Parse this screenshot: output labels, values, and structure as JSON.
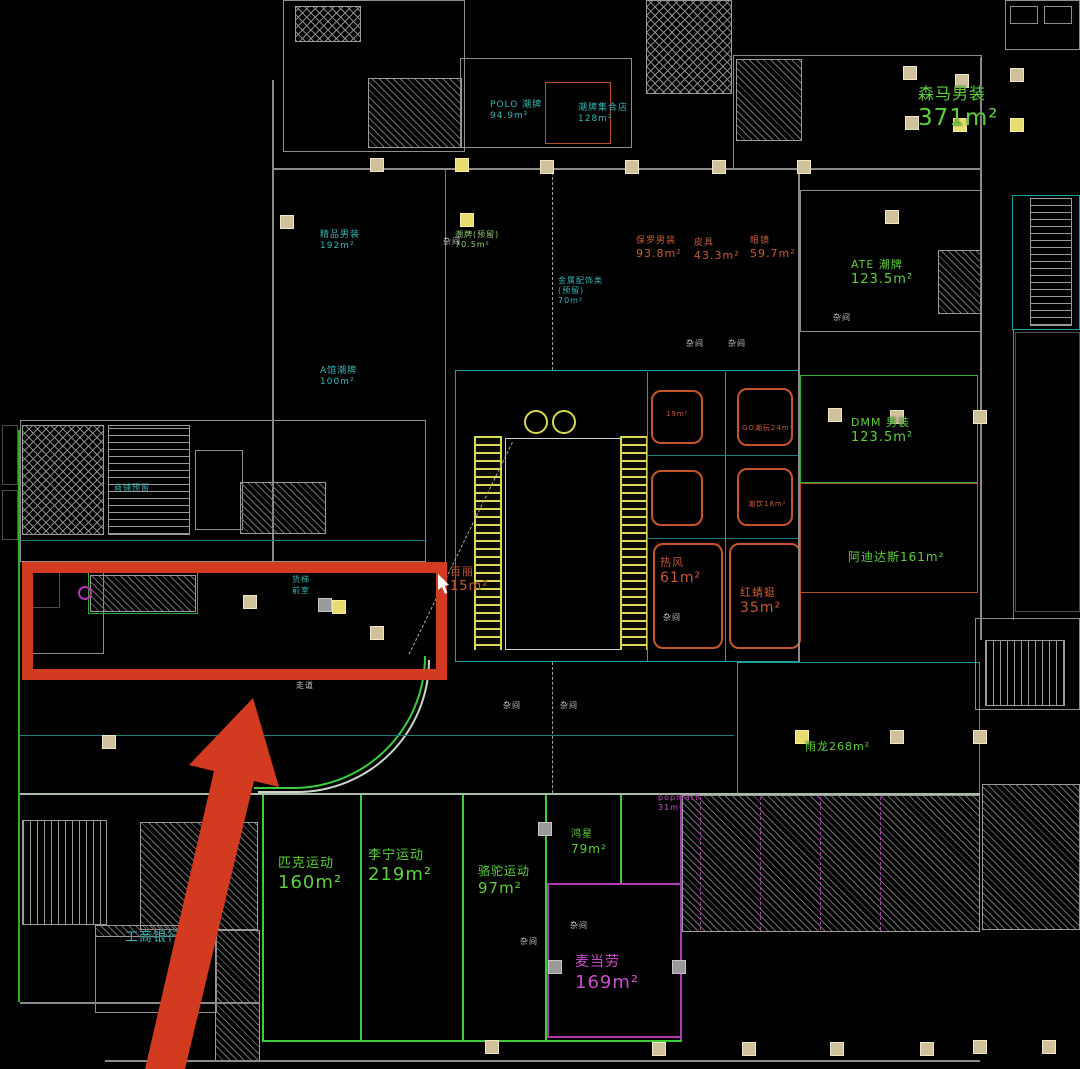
{
  "drawing": {
    "type": "cad-floor-plan",
    "background": "#000000",
    "accent_colors": {
      "highlight_red": "#d23b20",
      "tenant_green": "#5ecf3e",
      "tenant_cyan": "#36b6b6",
      "tenant_orange": "#c65a35",
      "tenant_magenta": "#c94fc9",
      "escalator_yellow": "#d8d855",
      "column_tan": "#cfc19c"
    },
    "annotations": {
      "highlight_rect": {
        "color": "#d23b20"
      },
      "arrow": {
        "color": "#d23b20"
      },
      "cursor": {
        "color": "#ffffff"
      }
    },
    "stores": [
      {
        "id": "senma",
        "color": "#5ecf3e",
        "x": 918,
        "y": 84,
        "lines": [
          {
            "t": "森马男装",
            "s": 16
          },
          {
            "t": "371m²",
            "s": 23
          }
        ]
      },
      {
        "id": "polo",
        "color": "#36b6b6",
        "x": 490,
        "y": 100,
        "lines": [
          {
            "t": "POLO 潮牌",
            "s": 9
          },
          {
            "t": "94.9m²",
            "s": 9
          }
        ]
      },
      {
        "id": "jihe",
        "color": "#36b6b6",
        "x": 578,
        "y": 103,
        "lines": [
          {
            "t": "潮牌集合店",
            "s": 9
          },
          {
            "t": "128m²",
            "s": 9
          }
        ]
      },
      {
        "id": "mens192",
        "color": "#36b6b6",
        "x": 320,
        "y": 230,
        "lines": [
          {
            "t": "精品男装",
            "s": 9
          },
          {
            "t": "192m²",
            "s": 9
          }
        ]
      },
      {
        "id": "chaopai705",
        "color": "#8fcf6f",
        "x": 455,
        "y": 230,
        "lines": [
          {
            "t": "潮牌(预留)",
            "s": 8
          },
          {
            "t": "70.5m²",
            "s": 8
          }
        ]
      },
      {
        "id": "jinshu",
        "color": "#36b6b6",
        "x": 558,
        "y": 276,
        "lines": [
          {
            "t": "金属配饰类",
            "s": 8
          },
          {
            "t": "(预留)",
            "s": 8
          },
          {
            "t": "70m²",
            "s": 8
          }
        ]
      },
      {
        "id": "baoluo",
        "color": "#c65a35",
        "x": 636,
        "y": 236,
        "lines": [
          {
            "t": "保罗男装",
            "s": 9
          },
          {
            "t": "93.8m²",
            "s": 11
          }
        ]
      },
      {
        "id": "piju",
        "color": "#c65a35",
        "x": 694,
        "y": 238,
        "lines": [
          {
            "t": "皮具",
            "s": 9
          },
          {
            "t": "43.3m²",
            "s": 11
          }
        ]
      },
      {
        "id": "yanjing",
        "color": "#c65a35",
        "x": 750,
        "y": 236,
        "lines": [
          {
            "t": "眼镜",
            "s": 9
          },
          {
            "t": "59.7m²",
            "s": 11
          }
        ]
      },
      {
        "id": "ate",
        "color": "#5ecf3e",
        "x": 851,
        "y": 258,
        "lines": [
          {
            "t": "ATE 潮牌",
            "s": 11
          },
          {
            "t": "123.5m²",
            "s": 13
          }
        ]
      },
      {
        "id": "dmm",
        "color": "#5ecf3e",
        "x": 851,
        "y": 416,
        "lines": [
          {
            "t": "DMM 男装",
            "s": 11
          },
          {
            "t": "123.5m²",
            "s": 13
          }
        ]
      },
      {
        "id": "adidas",
        "color": "#5ecf3e",
        "x": 848,
        "y": 550,
        "lines": [
          {
            "t": "阿迪达斯161m²",
            "s": 12
          }
        ]
      },
      {
        "id": "baili",
        "color": "#c65a35",
        "x": 450,
        "y": 565,
        "lines": [
          {
            "t": "百丽",
            "s": 11
          },
          {
            "t": "15m²",
            "s": 13
          }
        ]
      },
      {
        "id": "refeng",
        "color": "#c65a35",
        "x": 660,
        "y": 556,
        "lines": [
          {
            "t": "热风",
            "s": 11
          },
          {
            "t": "61m²",
            "s": 14
          }
        ]
      },
      {
        "id": "hongqingting",
        "color": "#c65a35",
        "x": 740,
        "y": 586,
        "lines": [
          {
            "t": "红蜻蜓",
            "s": 11
          },
          {
            "t": "35m²",
            "s": 14
          }
        ]
      },
      {
        "id": "yulong",
        "color": "#5ecf3e",
        "x": 805,
        "y": 740,
        "lines": [
          {
            "t": "雨龙268m²",
            "s": 11
          }
        ]
      },
      {
        "id": "pike",
        "color": "#5ecf3e",
        "x": 278,
        "y": 856,
        "lines": [
          {
            "t": "匹克运动",
            "s": 13
          },
          {
            "t": "160m²",
            "s": 18
          }
        ]
      },
      {
        "id": "lining",
        "color": "#5ecf3e",
        "x": 368,
        "y": 848,
        "lines": [
          {
            "t": "李宁运动",
            "s": 13
          },
          {
            "t": "219m²",
            "s": 18
          }
        ]
      },
      {
        "id": "luotuo",
        "color": "#5ecf3e",
        "x": 478,
        "y": 864,
        "lines": [
          {
            "t": "骆驼运动",
            "s": 12
          },
          {
            "t": "97m²",
            "s": 15
          }
        ]
      },
      {
        "id": "hongxing",
        "color": "#5ecf3e",
        "x": 571,
        "y": 829,
        "lines": [
          {
            "t": "鸿星",
            "s": 10
          },
          {
            "t": "79m²",
            "s": 12
          }
        ]
      },
      {
        "id": "mcdonalds",
        "color": "#c94fc9",
        "x": 575,
        "y": 954,
        "lines": [
          {
            "t": "麦当劳",
            "s": 14
          },
          {
            "t": "169m²",
            "s": 18
          }
        ]
      },
      {
        "id": "icbc",
        "color": "#36b6b6",
        "x": 125,
        "y": 930,
        "lines": [
          {
            "t": "工商银行",
            "s": 13
          }
        ]
      },
      {
        "id": "popmart",
        "color": "#c94fc9",
        "x": 658,
        "y": 793,
        "lines": [
          {
            "t": "popmart",
            "s": 8
          },
          {
            "t": "31m²",
            "s": 8
          }
        ]
      },
      {
        "id": "aguan",
        "color": "#36b6b6",
        "x": 320,
        "y": 366,
        "lines": [
          {
            "t": "A馆潮牌",
            "s": 9
          },
          {
            "t": "100m²",
            "s": 9
          }
        ]
      },
      {
        "id": "kiosk1",
        "color": "#c65a35",
        "x": 666,
        "y": 410,
        "lines": [
          {
            "t": "19m²",
            "s": 7
          }
        ]
      },
      {
        "id": "kiosk2",
        "color": "#c65a35",
        "x": 742,
        "y": 424,
        "lines": [
          {
            "t": "GO潮玩24m²",
            "s": 7
          }
        ]
      },
      {
        "id": "kiosk3",
        "color": "#c65a35",
        "x": 748,
        "y": 500,
        "lines": [
          {
            "t": "潮饮18m²",
            "s": 7
          }
        ]
      }
    ],
    "small_labels": [
      {
        "t": "杂间",
        "x": 443,
        "y": 236
      },
      {
        "t": "杂间",
        "x": 503,
        "y": 700
      },
      {
        "t": "杂间",
        "x": 560,
        "y": 700
      },
      {
        "t": "杂间",
        "x": 663,
        "y": 612
      },
      {
        "t": "杂间",
        "x": 570,
        "y": 920
      },
      {
        "t": "杂间",
        "x": 520,
        "y": 936
      },
      {
        "t": "杂间",
        "x": 686,
        "y": 338
      },
      {
        "t": "杂间",
        "x": 728,
        "y": 338
      },
      {
        "t": "杂间",
        "x": 833,
        "y": 312
      },
      {
        "t": "走道",
        "x": 296,
        "y": 680
      },
      {
        "t": "货梯",
        "x": 292,
        "y": 574,
        "c": "#36b6b6"
      },
      {
        "t": "前室",
        "x": 292,
        "y": 585,
        "c": "#36b6b6"
      },
      {
        "t": "商铺预留",
        "x": 114,
        "y": 482,
        "c": "#36b6b6"
      }
    ]
  }
}
